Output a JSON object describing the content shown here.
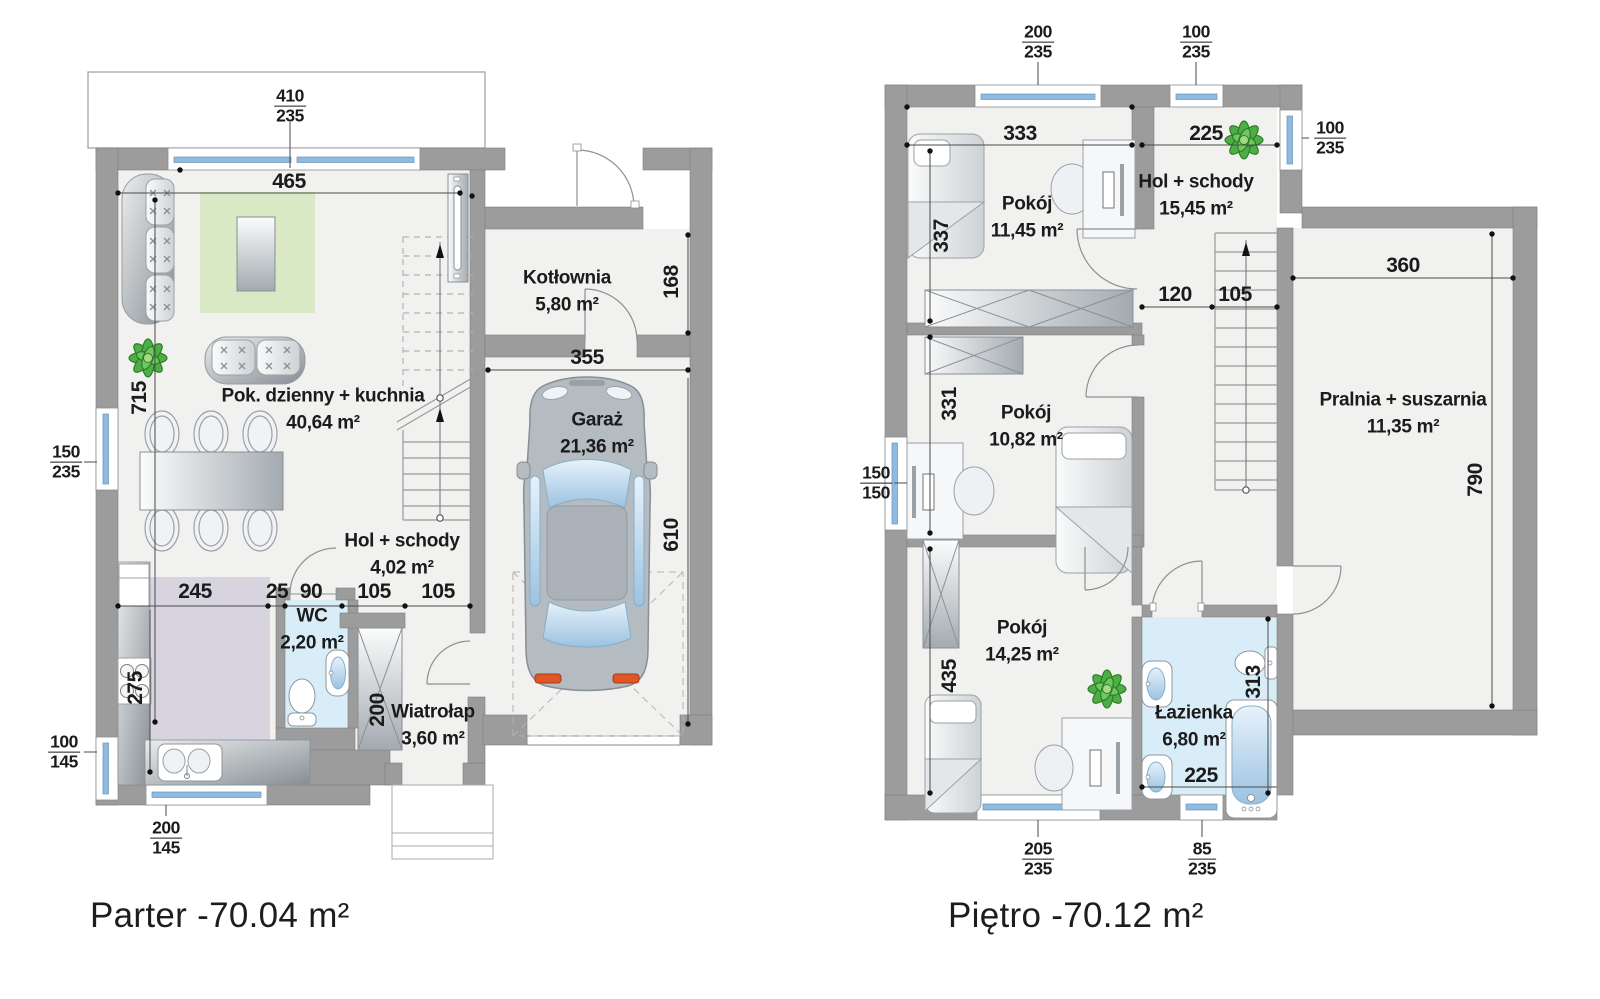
{
  "palette": {
    "wall": "#9c9c9c",
    "wall-edge": "#7f7f7f",
    "floor": "#f1f1f0",
    "pane": "#8fbbe2",
    "pane-light": "#cfe3f4",
    "rug": "#d9e9c6",
    "bath": "#d9edf9",
    "kitchen": "#d7d4e0",
    "plant-green": "#4cae45",
    "dim-ink": "#1b1b1b"
  },
  "parter": {
    "title": "Parter -70.04 m²",
    "rooms": {
      "living": {
        "name": "Pok. dzienny + kuchnia",
        "area": "40,64 m²"
      },
      "boiler": {
        "name": "Kotłownia",
        "area": "5,80 m²"
      },
      "garage": {
        "name": "Garaż",
        "area": "21,36 m²"
      },
      "hall": {
        "name": "Hol + schody",
        "area": "4,02 m²"
      },
      "wc": {
        "name": "WC",
        "area": "2,20 m²"
      },
      "vestibule": {
        "name": "Wiatrołap",
        "area": "3,60 m²"
      }
    },
    "dims": {
      "living_width": "465",
      "living_height": "715",
      "boiler_depth": "168",
      "garage_width": "355",
      "garage_height": "610",
      "kitchen_run": "245",
      "gap": "25",
      "wc_width": "90",
      "hall_a": "105",
      "hall_b": "105",
      "kitchen_depth": "275",
      "closet_depth": "200"
    },
    "windows": {
      "terrace": {
        "w": "410",
        "h": "235"
      },
      "side": {
        "w": "150",
        "h": "235"
      },
      "corner_side": {
        "w": "100",
        "h": "145"
      },
      "corner_bottom": {
        "w": "200",
        "h": "145"
      }
    }
  },
  "pietro": {
    "title": "Piętro -70.12 m²",
    "rooms": {
      "room1": {
        "name": "Pokój",
        "area": "11,45 m²"
      },
      "hall": {
        "name": "Hol + schody",
        "area": "15,45 m²"
      },
      "room2": {
        "name": "Pokój",
        "area": "10,82 m²"
      },
      "laundry": {
        "name": "Pralnia + suszarnia",
        "area": "11,35 m²"
      },
      "room3": {
        "name": "Pokój",
        "area": "14,25 m²"
      },
      "bath": {
        "name": "Łazienka",
        "area": "6,80 m²"
      }
    },
    "dims": {
      "room1_width": "333",
      "hall_width": "225",
      "room1_height": "337",
      "stair_a": "120",
      "stair_b": "105",
      "laundry_width": "360",
      "room2_height": "331",
      "laundry_height": "790",
      "room3_height": "435",
      "bath_height": "313",
      "bath_width": "225"
    },
    "windows": {
      "top_large": {
        "w": "200",
        "h": "235"
      },
      "top_small": {
        "w": "100",
        "h": "235"
      },
      "right": {
        "w": "100",
        "h": "235"
      },
      "side": {
        "w": "150",
        "h": "150"
      },
      "bottom_large": {
        "w": "205",
        "h": "235"
      },
      "bottom_small": {
        "w": "85",
        "h": "235"
      }
    }
  }
}
